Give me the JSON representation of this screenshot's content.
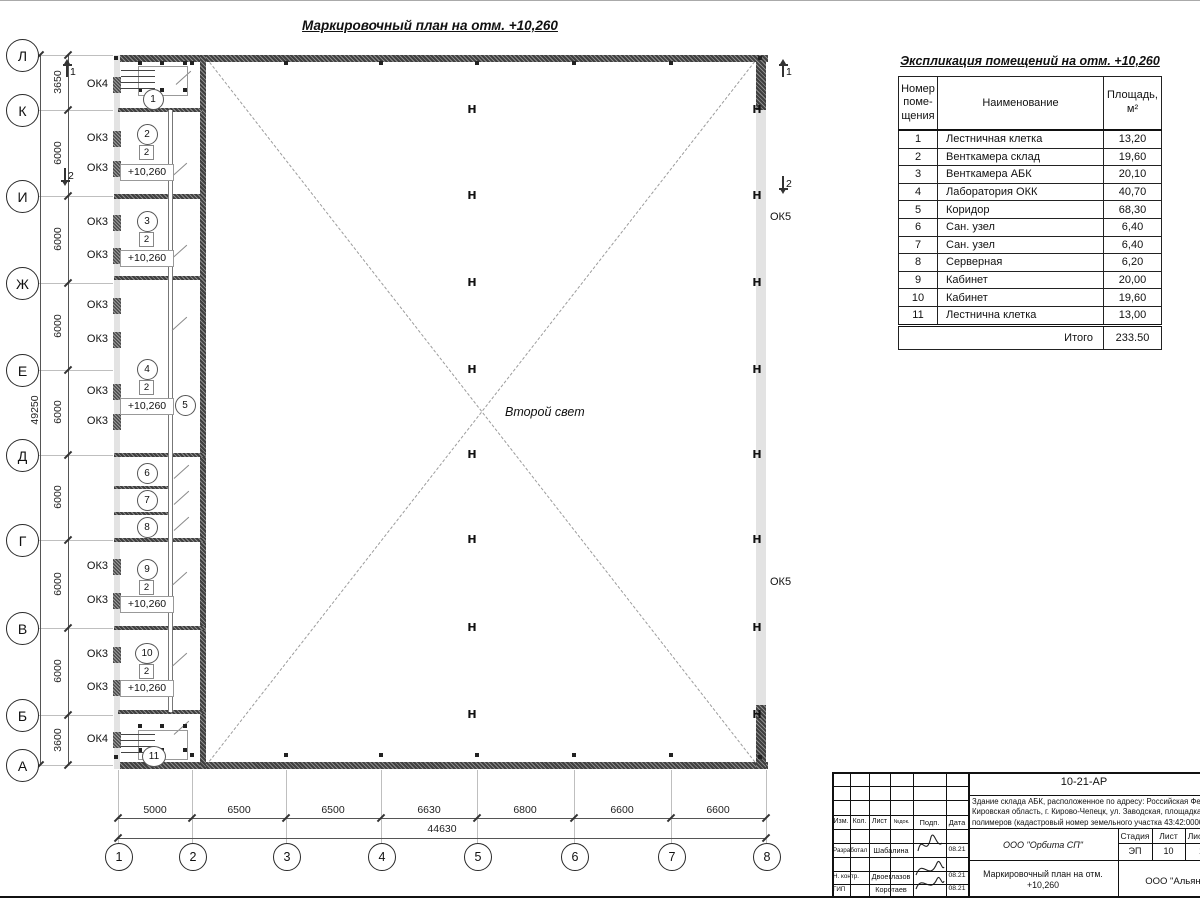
{
  "plan": {
    "title": "Маркировочный план на отм. +10,260",
    "second_light_label": "Второй свет",
    "column_mark": "Н",
    "row_axes": [
      {
        "label": "Л",
        "y": 55
      },
      {
        "label": "К",
        "y": 110
      },
      {
        "label": "И",
        "y": 196
      },
      {
        "label": "Ж",
        "y": 283
      },
      {
        "label": "Е",
        "y": 370
      },
      {
        "label": "Д",
        "y": 455
      },
      {
        "label": "Г",
        "y": 540
      },
      {
        "label": "В",
        "y": 628
      },
      {
        "label": "Б",
        "y": 715
      },
      {
        "label": "А",
        "y": 765
      }
    ],
    "col_axes": [
      {
        "label": "1",
        "x": 118
      },
      {
        "label": "2",
        "x": 192
      },
      {
        "label": "3",
        "x": 286
      },
      {
        "label": "4",
        "x": 381
      },
      {
        "label": "5",
        "x": 477
      },
      {
        "label": "6",
        "x": 574
      },
      {
        "label": "7",
        "x": 671
      },
      {
        "label": "8",
        "x": 766
      }
    ],
    "left_dims": [
      {
        "text": "3650",
        "y": 82
      },
      {
        "text": "6000",
        "y": 153
      },
      {
        "text": "6000",
        "y": 239
      },
      {
        "text": "6000",
        "y": 326
      },
      {
        "text": "6000",
        "y": 412
      },
      {
        "text": "6000",
        "y": 497
      },
      {
        "text": "6000",
        "y": 584
      },
      {
        "text": "6000",
        "y": 671
      },
      {
        "text": "3600",
        "y": 740
      }
    ],
    "left_total_dim": "49250",
    "bottom_dims": [
      {
        "text": "5000",
        "x": 155
      },
      {
        "text": "6500",
        "x": 239
      },
      {
        "text": "6500",
        "x": 333
      },
      {
        "text": "6630",
        "x": 429
      },
      {
        "text": "6800",
        "x": 525
      },
      {
        "text": "6600",
        "x": 622
      },
      {
        "text": "6600",
        "x": 718
      }
    ],
    "bottom_total_dim": "44630",
    "window_labels_left": [
      {
        "text": "ОК4",
        "y": 85
      },
      {
        "text": "ОК3",
        "y": 139
      },
      {
        "text": "ОК3",
        "y": 169
      },
      {
        "text": "ОК3",
        "y": 223
      },
      {
        "text": "ОК3",
        "y": 256
      },
      {
        "text": "ОК3",
        "y": 306
      },
      {
        "text": "ОК3",
        "y": 340
      },
      {
        "text": "ОК3",
        "y": 392
      },
      {
        "text": "ОК3",
        "y": 422
      },
      {
        "text": "ОК3",
        "y": 567
      },
      {
        "text": "ОК3",
        "y": 601
      },
      {
        "text": "ОК3",
        "y": 655
      },
      {
        "text": "ОК3",
        "y": 688
      },
      {
        "text": "ОК4",
        "y": 740
      }
    ],
    "window_labels_right": [
      {
        "text": "ОК5",
        "y": 218
      },
      {
        "text": "ОК5",
        "y": 583
      }
    ],
    "rooms": [
      {
        "num": "1",
        "x": 152,
        "y": 98
      },
      {
        "num": "2",
        "x": 146,
        "y": 133,
        "badge": "2",
        "elev": "+10,260",
        "elev_y": 172
      },
      {
        "num": "3",
        "x": 146,
        "y": 220,
        "badge": "2",
        "elev": "+10,260",
        "elev_y": 258
      },
      {
        "num": "4",
        "x": 146,
        "y": 368,
        "badge": "2",
        "elev": "+10,260",
        "elev_y": 406
      },
      {
        "num": "5",
        "x": 184,
        "y": 404
      },
      {
        "num": "6",
        "x": 146,
        "y": 472
      },
      {
        "num": "7",
        "x": 146,
        "y": 499
      },
      {
        "num": "8",
        "x": 146,
        "y": 526
      },
      {
        "num": "9",
        "x": 146,
        "y": 568,
        "badge": "2",
        "elev": "+10,260",
        "elev_y": 604
      },
      {
        "num": "10",
        "x": 146,
        "y": 652,
        "badge": "2",
        "elev": "+10,260",
        "elev_y": 688
      },
      {
        "num": "11",
        "x": 153,
        "y": 755
      }
    ],
    "section_marks": [
      {
        "label": "1",
        "x": 66,
        "y": 64,
        "dir": "up"
      },
      {
        "label": "1",
        "x": 782,
        "y": 64,
        "dir": "up"
      },
      {
        "label": "2",
        "x": 64,
        "y": 168,
        "dir": "down"
      },
      {
        "label": "2",
        "x": 782,
        "y": 176,
        "dir": "down"
      }
    ]
  },
  "schedule": {
    "title": "Экспликация помещений на отм. +10,260",
    "header_num_lines": [
      "Номер",
      "поме-",
      "щения"
    ],
    "header_name": "Наименование",
    "header_area_lines": [
      "Площадь,",
      "м²"
    ],
    "rows": [
      {
        "num": "1",
        "name": "Лестничная клетка",
        "area": "13,20"
      },
      {
        "num": "2",
        "name": "Венткамера склад",
        "area": "19,60"
      },
      {
        "num": "3",
        "name": "Венткамера АБК",
        "area": "20,10"
      },
      {
        "num": "4",
        "name": "Лаборатория ОКК",
        "area": "40,70"
      },
      {
        "num": "5",
        "name": "Коридор",
        "area": "68,30"
      },
      {
        "num": "6",
        "name": "Сан. узел",
        "area": "6,40"
      },
      {
        "num": "7",
        "name": "Сан. узел",
        "area": "6,40"
      },
      {
        "num": "8",
        "name": "Серверная",
        "area": "6,20"
      },
      {
        "num": "9",
        "name": "Кабинет",
        "area": "20,00"
      },
      {
        "num": "10",
        "name": "Кабинет",
        "area": "19,60"
      },
      {
        "num": "11",
        "name": "Лестнична клетка",
        "area": "13,00"
      }
    ],
    "total_label": "Итого",
    "total_value": "233.50"
  },
  "titleblock": {
    "doc_number": "10-21-АР",
    "address_lines": [
      "Здание склада АБК, расположенное по адресу: Российская Федерация,",
      "Кировская область, г. Кирово-Чепецк, ул. Заводская, площадка завода",
      "полимеров (кадастровый номер земельного участка 43:42:000000"
    ],
    "columns": [
      "Изм.",
      "Кол.",
      "Лист",
      "№док.",
      "Подп.",
      "Дата"
    ],
    "sig_rows": [
      {
        "role": "Разработал",
        "name": "Шабалина",
        "date": "08.21"
      },
      {
        "role": "Н. контр.",
        "name": "Двоеглазов",
        "date": "08.21"
      },
      {
        "role": "ГИП",
        "name": "Коротаев",
        "date": "08.21"
      }
    ],
    "org": "ООО \"Орбита СП\"",
    "stage_headers": [
      "Стадия",
      "Лист",
      "Листов"
    ],
    "stage_values": [
      "ЭП",
      "10",
      "1"
    ],
    "sheet_title": "Маркировочный план на отм. +10,260",
    "company": "ООО \"Альянс\""
  }
}
